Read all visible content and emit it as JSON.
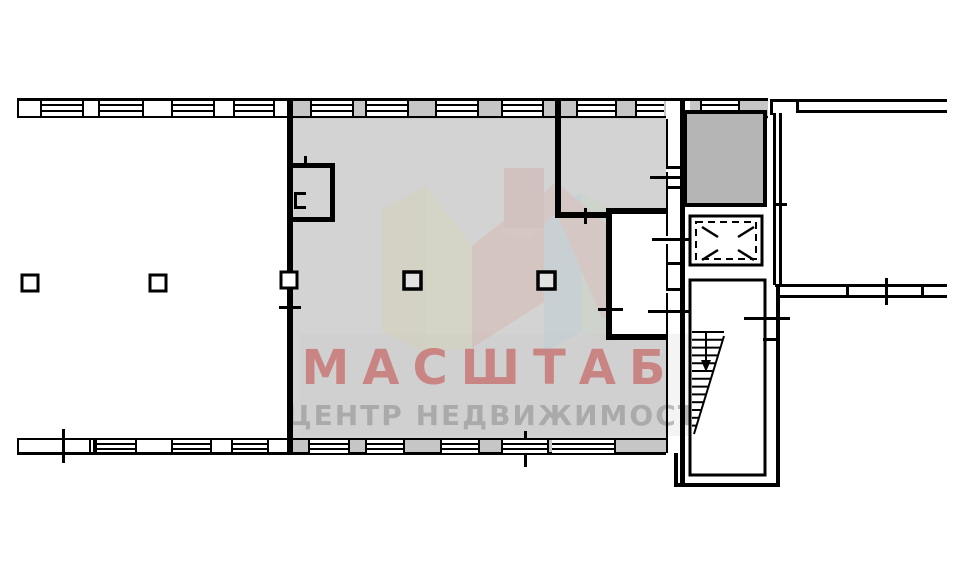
{
  "watermark": {
    "title": "МАСШТАБ",
    "subtitle": "ЦЕНТР НЕДВИЖИМОСТИ",
    "title_color": "#c33c39",
    "subtitle_color": "#8c8c8c"
  },
  "plan": {
    "background": "#ffffff",
    "wall_color": "#000000",
    "unit_fill": "#d3d3d3",
    "wall_band_fill": "#c6c6c6",
    "dark_room_fill": "#b5b5b5",
    "stair_fill": "#ffffff",
    "elevator_fill": "#ffffff"
  }
}
